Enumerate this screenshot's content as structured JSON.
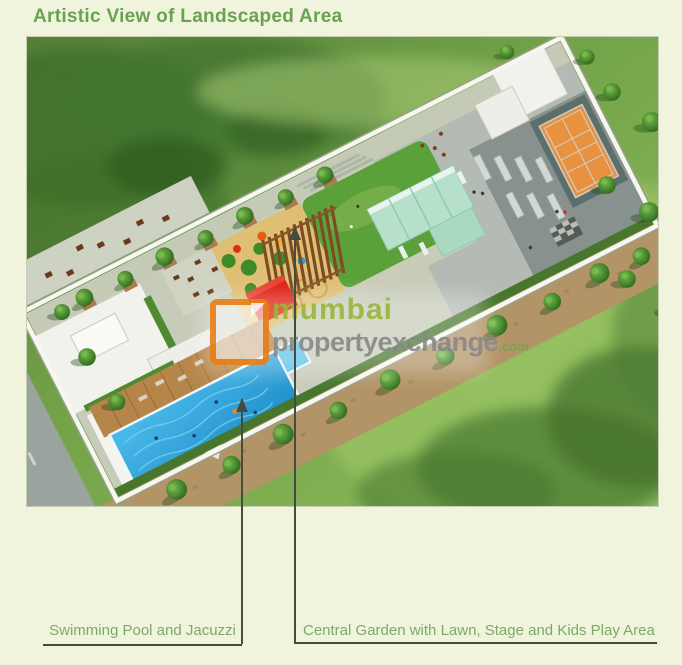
{
  "title": "Artistic View of Landscaped Area",
  "callouts": {
    "pool": "Swimming Pool and Jacuzzi",
    "garden": "Central Garden with Lawn, Stage and Kids Play Area"
  },
  "watermark": {
    "brand": "mumbai",
    "domain": "propertyexchange",
    "tld": ".com"
  },
  "scene_legend": {
    "swimming_pool": "blue pool with jacuzzi at lower left",
    "central_garden": "green lawn with stage and kids play area at center",
    "tennis_court": "orange court at upper right",
    "red_stage": "red stage beside pergola",
    "perimeter": "white compound wall with trees"
  },
  "colors": {
    "page_bg": "#f0f4dd",
    "title_green": "#6aa251",
    "label_green": "#7ca968",
    "line_dark": "#464b40",
    "wm_green": "#9cb83e",
    "wm_green2": "#7aa34d",
    "wm_gray": "#8b8b8b",
    "wm_orange": "#e8821e",
    "pool_blue": "#2da2d8",
    "lawn_green": "#5ba13a",
    "tennis_orange": "#e8923f",
    "stage_red": "#dd2114",
    "mint_wall": "#b7e0cb",
    "deck_brown": "#b5854a",
    "path_tan": "#b29467"
  }
}
